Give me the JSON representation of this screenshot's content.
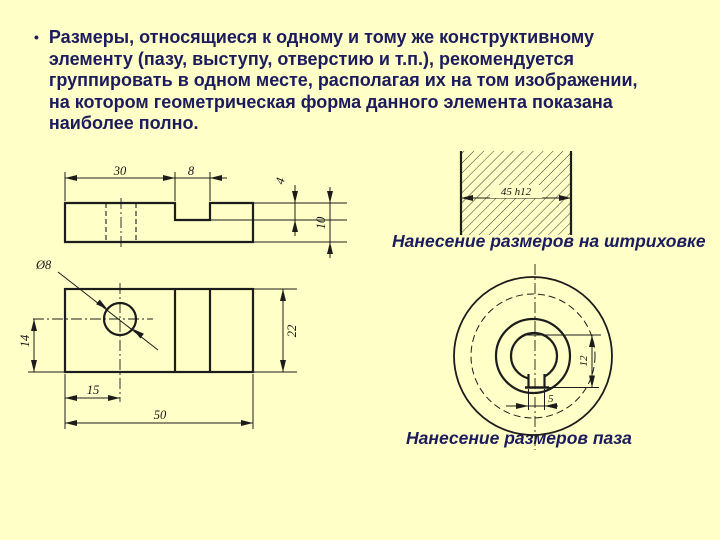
{
  "slide": {
    "background_color": "#FFFFC8",
    "text_color": "#1B1B5E",
    "bullet_marker": "•",
    "bullet_text": "Размеры, относящиеся к одному и тому же конструктивному\nэлементу (пазу, выступу, отверстию и т.п.), рекомендуется\nгруппировать в одном месте, располагая их на том изображении,\nна котором геометрическая форма данного элемента показана\nнаиболее полно."
  },
  "captions": {
    "hatch": "Нанесение размеров на штриховке",
    "keyway": "Нанесение размеров паза"
  },
  "front_view": {
    "dim_30": "30",
    "dim_8": "8",
    "dim_4": "4",
    "dim_10": "10"
  },
  "top_view": {
    "dim_dia": "Ø8",
    "dim_14": "14",
    "dim_15": "15",
    "dim_50": "50",
    "dim_22": "22"
  },
  "hatch_figure": {
    "dim_width": "45 h12"
  },
  "keyway_figure": {
    "dim_12": "12",
    "dim_5": "5"
  }
}
